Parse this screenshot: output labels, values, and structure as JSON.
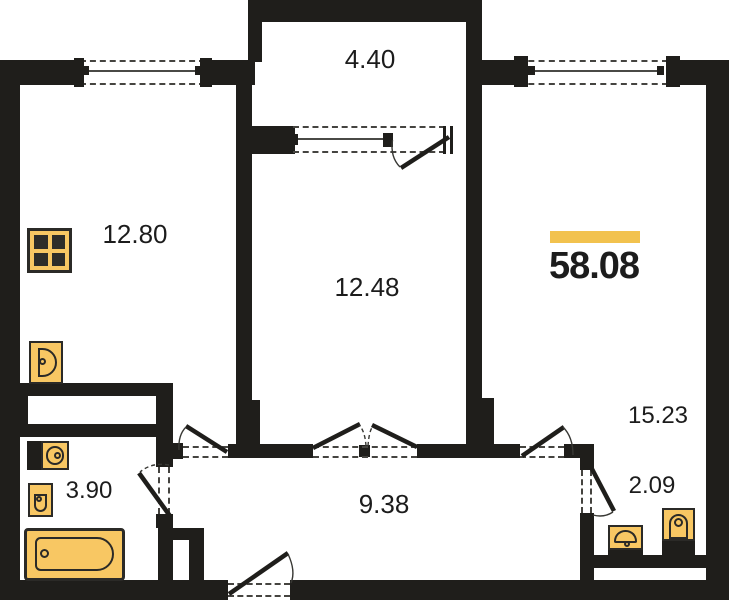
{
  "plan": {
    "type": "apartment-floor-plan",
    "total_area": "58.08",
    "rooms": {
      "kitchen": "12.80",
      "balcony": "4.40",
      "room_center": "12.48",
      "room_right": "15.23",
      "bathroom": "3.90",
      "hallway": "9.38",
      "wc": "2.09"
    },
    "colors": {
      "wall": "#1f1e1b",
      "fixture_fill": "#f8c763",
      "fixture_outline": "#2b2a27",
      "accent_bar": "#f2c24e",
      "text": "#1c1c1c"
    },
    "icons": [
      "stove-icon",
      "kitchen-sink-icon",
      "bathroom-sink-icon",
      "washbasin-icon",
      "bathtub-icon",
      "wc-sink-icon",
      "toilet-icon"
    ]
  }
}
